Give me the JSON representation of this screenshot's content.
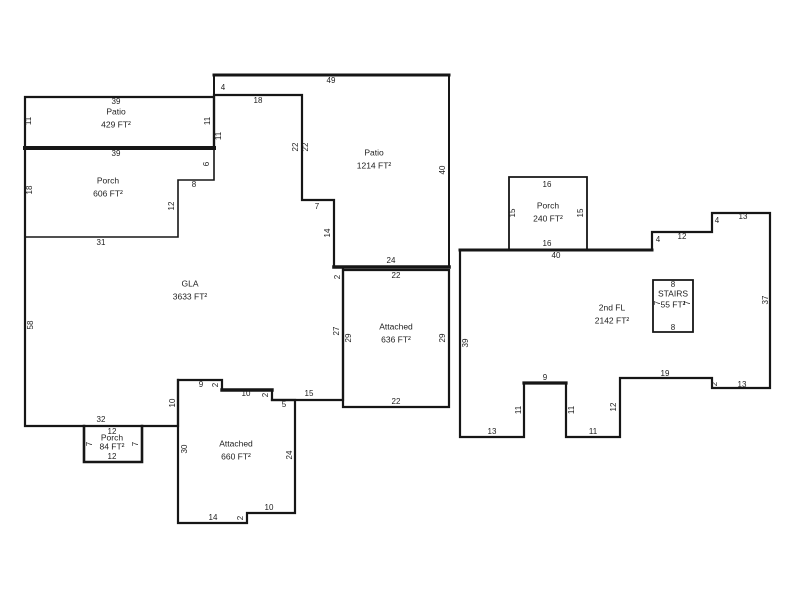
{
  "title": "Floor plan sketch",
  "floorplan": {
    "width": 800,
    "height": 600,
    "background": "#ffffff",
    "line_color": "#161616",
    "text_color": "#1d1d1d",
    "rooms": [
      {
        "id": "patio-upper-left",
        "name": "Patio",
        "area": "429 FT²",
        "x": 116,
        "y": 112,
        "gap": 13
      },
      {
        "id": "porch-left",
        "name": "Porch",
        "area": "606 FT²",
        "x": 108,
        "y": 181,
        "gap": 13
      },
      {
        "id": "patio-top",
        "name": "Patio",
        "area": "1214 FT²",
        "x": 374,
        "y": 153,
        "gap": 13
      },
      {
        "id": "gla",
        "name": "GLA",
        "area": "3633 FT²",
        "x": 190,
        "y": 284,
        "gap": 13
      },
      {
        "id": "attached-right",
        "name": "Attached",
        "area": "636 FT²",
        "x": 396,
        "y": 327,
        "gap": 13
      },
      {
        "id": "attached-bottom",
        "name": "Attached",
        "area": "660 FT²",
        "x": 236,
        "y": 444,
        "gap": 13
      },
      {
        "id": "porch-small",
        "name": "Porch",
        "area": "84 FT²",
        "x": 112,
        "y": 438,
        "gap": 9
      },
      {
        "id": "porch-2nd",
        "name": "Porch",
        "area": "240 FT²",
        "x": 548,
        "y": 206,
        "gap": 13
      },
      {
        "id": "second-floor",
        "name": "2nd FL",
        "area": "2142 FT²",
        "x": 612,
        "y": 308,
        "gap": 13
      },
      {
        "id": "stairs",
        "name": "STAIRS",
        "area": "55 FT²",
        "x": 673,
        "y": 294,
        "gap": 11
      }
    ],
    "walls": [
      {
        "d": "25,97 214,97 214,148 25,148 25,97",
        "w": 2.2
      },
      {
        "d": "25,148 214,148",
        "w": 4
      },
      {
        "d": "214,148 214,180 178,180 178,237 25,237 25,148",
        "w": 1.6
      },
      {
        "d": "25,148 25,426 178,426 178,380 222,380 222,390 272,390 272,400 343,400 343,267 334,267 334,200 302,200 302,95 214,95 214,148 25,148",
        "w": 2.2
      },
      {
        "d": "214,75 449,75 449,267 334,267 334,200 302,200 302,95 214,95 214,75",
        "w": 2
      },
      {
        "d": "214,75 449,75",
        "w": 3
      },
      {
        "d": "334,267 449,267",
        "w": 3.6
      },
      {
        "d": "343,270 449,270 449,407 343,407 343,270",
        "w": 2.2
      },
      {
        "d": "178,380 178,523 247,523 247,513 295,513 295,400 272,400",
        "w": 2.2
      },
      {
        "d": "222,390 272,390",
        "w": 3.4
      },
      {
        "d": "84,426 84,462 142,462 142,426",
        "w": 2.6
      },
      {
        "d": "460,250 652,250 652,232 712,232 712,213 770,213 770,388 712,388 712,378 620,378 620,437 566,437 566,383 524,383 524,437 460,437 460,250",
        "w": 2.2
      },
      {
        "d": "460,250 652,250",
        "w": 3
      },
      {
        "d": "524,383 566,383",
        "w": 3.2
      },
      {
        "d": "509,250 509,177 587,177 587,250",
        "w": 1.8
      },
      {
        "d": "653,280 693,280 693,332 653,332 653,280",
        "w": 1.8
      }
    ],
    "dims": [
      {
        "t": "39",
        "x": 116,
        "y": 102
      },
      {
        "t": "11",
        "x": 29,
        "y": 121,
        "v": 1
      },
      {
        "t": "11",
        "x": 208,
        "y": 121,
        "v": 1
      },
      {
        "t": "39",
        "x": 116,
        "y": 154
      },
      {
        "t": "18",
        "x": 30,
        "y": 190,
        "v": 1
      },
      {
        "t": "6",
        "x": 207,
        "y": 164,
        "v": 1
      },
      {
        "t": "8",
        "x": 194,
        "y": 185
      },
      {
        "t": "12",
        "x": 172,
        "y": 206,
        "v": 1
      },
      {
        "t": "31",
        "x": 101,
        "y": 243
      },
      {
        "t": "49",
        "x": 331,
        "y": 81
      },
      {
        "t": "4",
        "x": 223,
        "y": 88
      },
      {
        "t": "18",
        "x": 258,
        "y": 101
      },
      {
        "t": "11",
        "x": 219,
        "y": 136,
        "v": 1
      },
      {
        "t": "22",
        "x": 296,
        "y": 147,
        "v": 1
      },
      {
        "t": "22",
        "x": 306,
        "y": 147,
        "v": 1
      },
      {
        "t": "7",
        "x": 317,
        "y": 207
      },
      {
        "t": "14",
        "x": 328,
        "y": 233,
        "v": 1
      },
      {
        "t": "40",
        "x": 443,
        "y": 170,
        "v": 1
      },
      {
        "t": "24",
        "x": 391,
        "y": 261
      },
      {
        "t": "2",
        "x": 338,
        "y": 277,
        "v": 1
      },
      {
        "t": "22",
        "x": 396,
        "y": 276
      },
      {
        "t": "27",
        "x": 337,
        "y": 331,
        "v": 1
      },
      {
        "t": "29",
        "x": 349,
        "y": 338,
        "v": 1
      },
      {
        "t": "29",
        "x": 443,
        "y": 338,
        "v": 1
      },
      {
        "t": "22",
        "x": 396,
        "y": 402
      },
      {
        "t": "58",
        "x": 31,
        "y": 325,
        "v": 1
      },
      {
        "t": "32",
        "x": 101,
        "y": 420
      },
      {
        "t": "9",
        "x": 201,
        "y": 385
      },
      {
        "t": "2",
        "x": 216,
        "y": 385,
        "v": 1
      },
      {
        "t": "10",
        "x": 246,
        "y": 394
      },
      {
        "t": "2",
        "x": 266,
        "y": 395,
        "v": 1
      },
      {
        "t": "15",
        "x": 309,
        "y": 394
      },
      {
        "t": "5",
        "x": 284,
        "y": 405
      },
      {
        "t": "10",
        "x": 173,
        "y": 403,
        "v": 1
      },
      {
        "t": "30",
        "x": 185,
        "y": 449,
        "v": 1
      },
      {
        "t": "24",
        "x": 290,
        "y": 455,
        "v": 1
      },
      {
        "t": "10",
        "x": 269,
        "y": 508
      },
      {
        "t": "2",
        "x": 241,
        "y": 518,
        "v": 1
      },
      {
        "t": "14",
        "x": 213,
        "y": 518
      },
      {
        "t": "12",
        "x": 112,
        "y": 432
      },
      {
        "t": "7",
        "x": 90,
        "y": 444,
        "v": 1
      },
      {
        "t": "7",
        "x": 136,
        "y": 444,
        "v": 1
      },
      {
        "t": "12",
        "x": 112,
        "y": 457
      },
      {
        "t": "16",
        "x": 547,
        "y": 185
      },
      {
        "t": "15",
        "x": 513,
        "y": 213,
        "v": 1
      },
      {
        "t": "15",
        "x": 581,
        "y": 213,
        "v": 1
      },
      {
        "t": "16",
        "x": 547,
        "y": 244
      },
      {
        "t": "40",
        "x": 556,
        "y": 256
      },
      {
        "t": "4",
        "x": 658,
        "y": 240
      },
      {
        "t": "12",
        "x": 682,
        "y": 237
      },
      {
        "t": "4",
        "x": 717,
        "y": 221
      },
      {
        "t": "13",
        "x": 743,
        "y": 217
      },
      {
        "t": "37",
        "x": 766,
        "y": 300,
        "v": 1
      },
      {
        "t": "39",
        "x": 466,
        "y": 343,
        "v": 1
      },
      {
        "t": "13",
        "x": 492,
        "y": 432
      },
      {
        "t": "11",
        "x": 519,
        "y": 410,
        "v": 1
      },
      {
        "t": "9",
        "x": 545,
        "y": 378
      },
      {
        "t": "11",
        "x": 572,
        "y": 410,
        "v": 1
      },
      {
        "t": "11",
        "x": 593,
        "y": 432
      },
      {
        "t": "12",
        "x": 614,
        "y": 407,
        "v": 1
      },
      {
        "t": "19",
        "x": 665,
        "y": 374
      },
      {
        "t": "2",
        "x": 715,
        "y": 384,
        "v": 1
      },
      {
        "t": "13",
        "x": 742,
        "y": 385
      },
      {
        "t": "8",
        "x": 673,
        "y": 285
      },
      {
        "t": "7",
        "x": 658,
        "y": 303,
        "v": 1
      },
      {
        "t": "7",
        "x": 688,
        "y": 303,
        "v": 1
      },
      {
        "t": "8",
        "x": 673,
        "y": 328
      }
    ]
  }
}
